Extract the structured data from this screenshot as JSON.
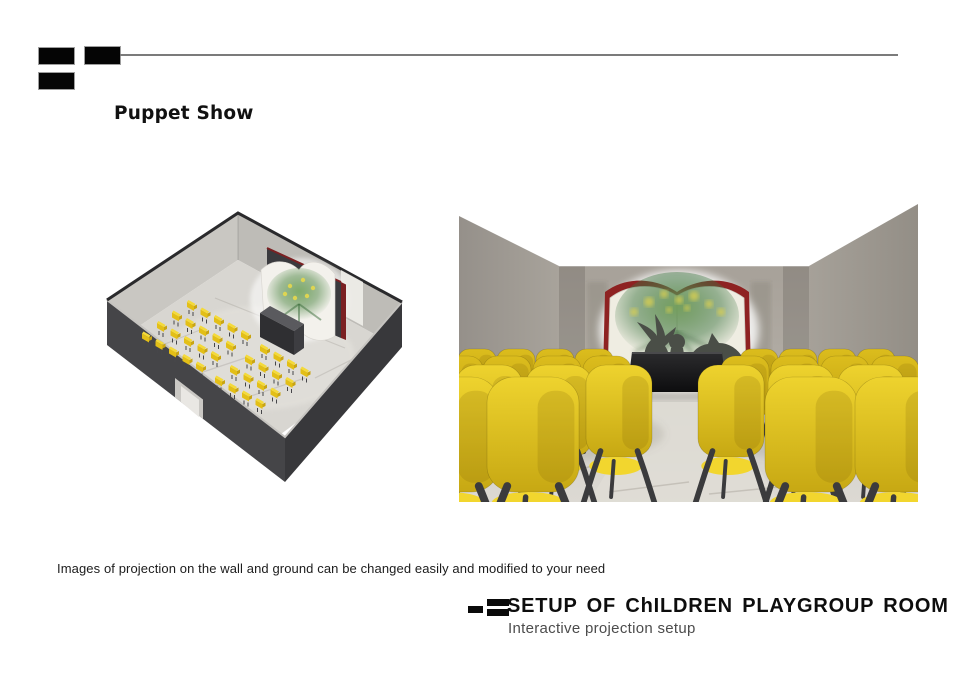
{
  "slide": {
    "background": "#ffffff",
    "header": {
      "brand_mark_icon": "three-black-rectangles",
      "rule_color": "#7b7b7b",
      "title": "Puppet Show"
    },
    "caption": "Images of projection on the wall and ground can be changed easily and modified to your need",
    "footer": {
      "brand_mark_icon": "three-black-bars",
      "title": "SETUP OF ChILDREN PLAYGROUP ROOM",
      "subtitle": "Interactive projection setup"
    },
    "figures": {
      "isometric": {
        "subject": "isometric cutaway render of playgroup room with yellow chairs facing open-book projection screen and stage",
        "wall_dark": "#454548",
        "wall_dark2": "#38383b",
        "wall_light": "#c9c7c2",
        "wall_light2": "#bebcb7",
        "rim_light": "#c6c4c0",
        "rim_dark": "#2a2a2c",
        "floor": "#d8d6d1",
        "floor_hi": "#e6e4df",
        "door": "#cac8c4",
        "door_in": "#e9e7e3",
        "slab": "#3a3a3e",
        "book_page": "#f3f1ec",
        "book_red": "#7b2022",
        "stage_top": "#5a5a5e",
        "stage_front": "#2f2f32",
        "stage_side": "#3d3d41",
        "chair_yellow": "#e3bf17",
        "chair_hi": "#f4da3a",
        "chair_shade": "#c9a512",
        "chair_leg": "#46464a",
        "blocks": [
          {
            "origin": [
              92,
              92
            ],
            "rows": 4,
            "cols": 5
          },
          {
            "origin": [
              165,
              136
            ],
            "rows": 4,
            "cols": 4
          }
        ],
        "col_step": [
          13.5,
          7.5
        ],
        "row_step": [
          -15,
          10.5
        ]
      },
      "perspective": {
        "subject": "eye-level render of playgroup room: yellow chairs in two blocks with centre aisle, open-book screen projecting bird and wolf puppet silhouettes over foliage, black stage",
        "wall_left": [
          "#95908a",
          "#a8a39b"
        ],
        "wall_right": [
          "#938e86",
          "#a6a199"
        ],
        "wall_back": [
          "#a7a199",
          "#b3aea6"
        ],
        "ceiling": "#ffffff",
        "floor": [
          "#cfccc6",
          "#dcd9d3"
        ],
        "aisle": "#e0ddd6",
        "stage": [
          "#2c2c2e",
          "#0d0d0f"
        ],
        "book_red": "#8e2222",
        "book_page": "#efede2",
        "proj_green": "#6f9b58",
        "proj_dark_green": "#3c7440",
        "proj_yellow": "#ddd14f",
        "silhouette": "#4a4e47",
        "chair_far": [
          "#dcbd1d",
          "#bfa011"
        ],
        "chair_near": [
          "#eed32e",
          "#c7a813"
        ],
        "chair_seat": "#f2d62e",
        "chair_leg": "#3b3b3d",
        "ranks_left": [
          {
            "y": 147,
            "h": 48,
            "w": 38,
            "leg": 26,
            "xs": [
              18,
              57,
              96,
              135
            ]
          },
          {
            "y": 154,
            "h": 62,
            "w": 48,
            "leg": 34,
            "xs": [
              0,
              48,
              98,
              148
            ]
          },
          {
            "y": 163,
            "h": 92,
            "w": 66,
            "leg": 50,
            "xs": [
              30,
              100,
              160
            ]
          },
          {
            "y": 175,
            "h": 115,
            "w": 92,
            "leg": 62,
            "xs": [
              -6,
              74
            ]
          }
        ],
        "ranks_right": [
          {
            "y": 147,
            "h": 48,
            "w": 38,
            "leg": 26,
            "xs": [
              300,
              339,
              378,
              417
            ]
          },
          {
            "y": 154,
            "h": 62,
            "w": 48,
            "leg": 34,
            "xs": [
              286,
              336,
              386,
              436
            ]
          },
          {
            "y": 163,
            "h": 92,
            "w": 66,
            "leg": 50,
            "xs": [
              272,
              342,
              412
            ]
          },
          {
            "y": 175,
            "h": 115,
            "w": 92,
            "leg": 62,
            "xs": [
              352,
              442
            ]
          }
        ]
      }
    }
  }
}
